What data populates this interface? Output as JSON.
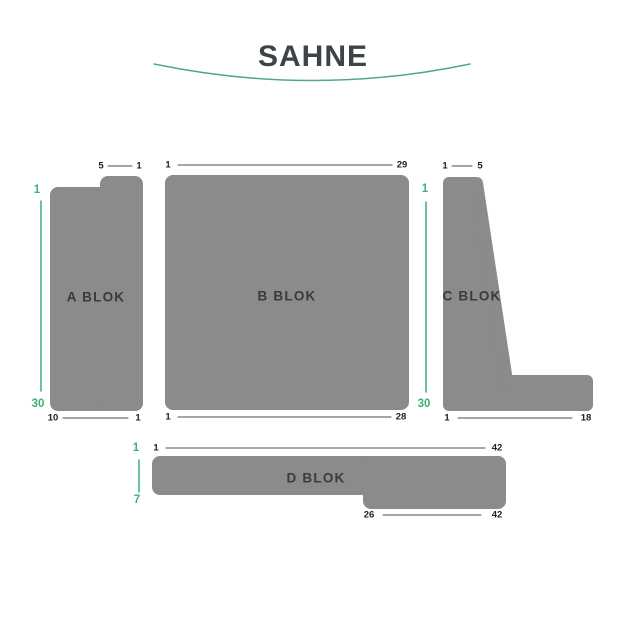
{
  "title": "SAHNE",
  "colors": {
    "block_fill": "#8B8B8B",
    "accent_green": "#3CB178",
    "stage_arc_green": "#52A885",
    "seat_number_text": "#1F1F1F",
    "block_label_text": "#3B3B3B",
    "title_text": "#3D4347",
    "connector_line": "#4D4D4D",
    "background": "#FFFFFF"
  },
  "blocks": [
    {
      "id": "A",
      "label": "A BLOK",
      "top_seats": {
        "left": "5",
        "right": "1"
      },
      "bottom_seats": {
        "left": "10",
        "right": "1"
      },
      "rows": {
        "start": "1",
        "end": "30",
        "side": "left"
      }
    },
    {
      "id": "B",
      "label": "B BLOK",
      "top_seats": {
        "left": "1",
        "right": "29"
      },
      "bottom_seats": {
        "left": "1",
        "right": "28"
      }
    },
    {
      "id": "C",
      "label": "C BLOK",
      "top_seats": {
        "left": "1",
        "right": "5"
      },
      "bottom_seats": {
        "left": "1",
        "right": "18"
      },
      "rows": {
        "start": "1",
        "end": "30",
        "side": "left"
      }
    },
    {
      "id": "D",
      "label": "D BLOK",
      "top_seats": {
        "left": "1",
        "right": "42"
      },
      "bottom_seats": {
        "left": "26",
        "right": "42"
      },
      "rows": {
        "start": "1",
        "end": "7",
        "side": "left"
      }
    }
  ]
}
